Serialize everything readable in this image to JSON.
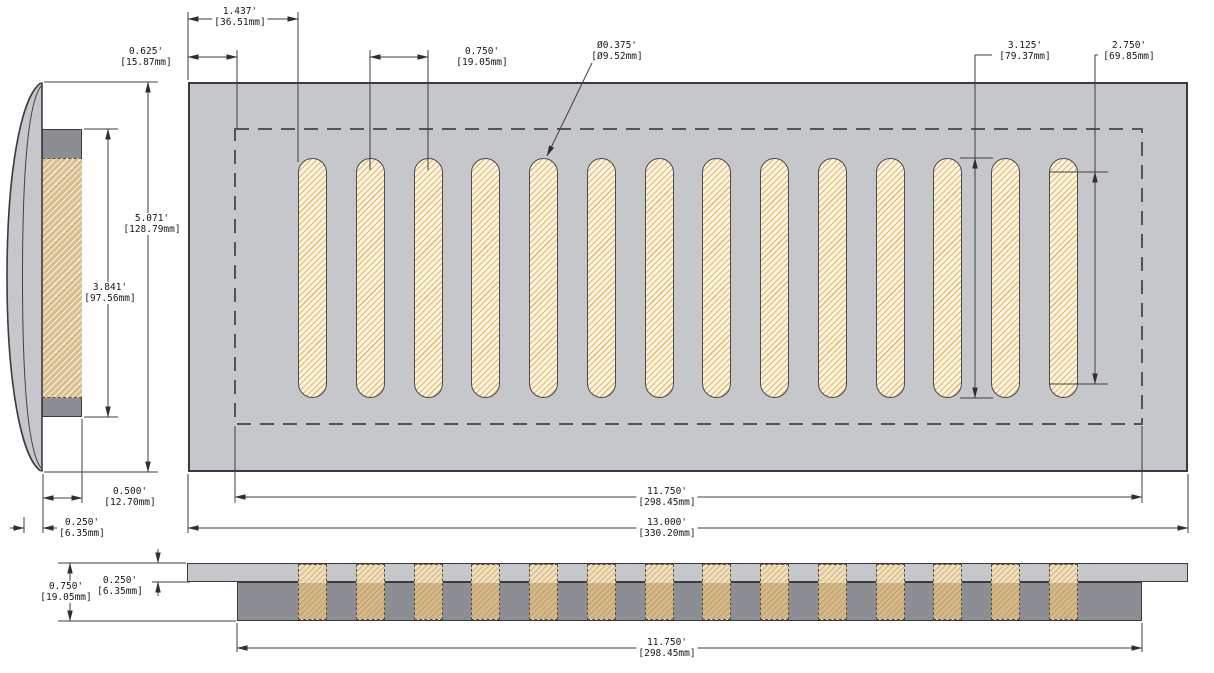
{
  "dims": {
    "slot_offset": {
      "in": "1.437'",
      "mm": "[36.51mm]"
    },
    "margin": {
      "in": "0.625'",
      "mm": "[15.87mm]"
    },
    "slot_pitch": {
      "in": "0.750'",
      "mm": "[19.05mm]"
    },
    "slot_dia": {
      "in": "Ø0.375'",
      "mm": "[Ø9.52mm]"
    },
    "slot_length": {
      "in": "3.125'",
      "mm": "[79.37mm]"
    },
    "slot_cc": {
      "in": "2.750'",
      "mm": "[69.85mm]"
    },
    "overall_height": {
      "in": "5.071'",
      "mm": "[128.79mm]"
    },
    "opening_height": {
      "in": "3.841'",
      "mm": "[97.56mm]"
    },
    "drop_depth": {
      "in": "0.500'",
      "mm": "[12.70mm]"
    },
    "face_thickness": {
      "in": "0.250'",
      "mm": "[6.35mm]"
    },
    "opening_width": {
      "in": "11.750'",
      "mm": "[298.45mm]"
    },
    "overall_width": {
      "in": "13.000'",
      "mm": "[330.20mm]"
    },
    "total_thickness": {
      "in": "0.750'",
      "mm": "[19.05mm]"
    },
    "plate_thickness": {
      "in": "0.250'",
      "mm": "[6.35mm]"
    },
    "duct_width": {
      "in": "11.750'",
      "mm": "[298.45mm]"
    }
  },
  "drawing": {
    "slot_count": 14,
    "slot_first_left_px": 298,
    "slot_pitch_px": 57.75,
    "slot_width_px": 29,
    "slot_top_px": 158,
    "slot_height_px": 240,
    "band_top_px": 564,
    "band_height_px": 56
  },
  "colors": {
    "plate": "#c6c7ca",
    "flange": "#8d8e93",
    "slot_fill": "#fbf4de",
    "slot_hatch": "#e5b671",
    "tan_fill": "#d8bd90",
    "tan_hatch": "#f6eed8",
    "cream_fill": "#f3e8cc",
    "band_top_fill": "#eedfbd",
    "band_bottom_fill": "#d3b88b",
    "line": "#3f3f45"
  }
}
